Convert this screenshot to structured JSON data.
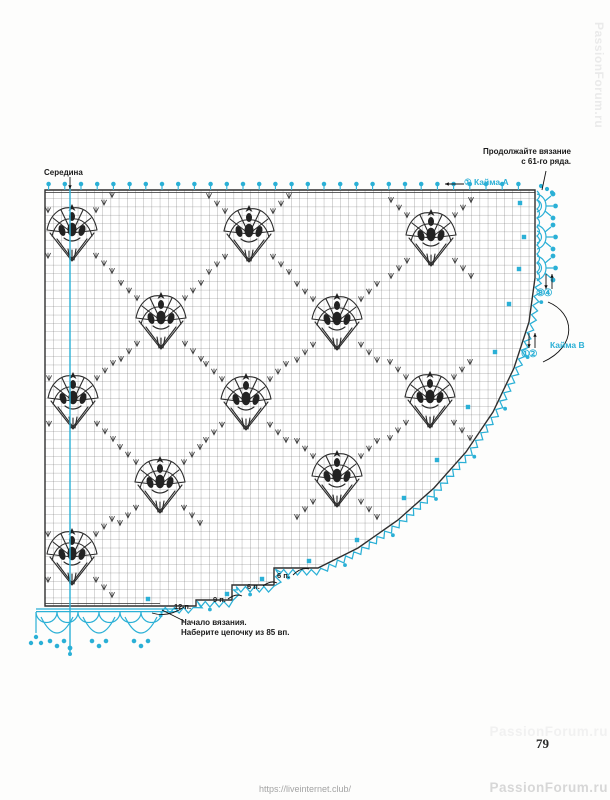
{
  "colors": {
    "accent": "#2bb0d6",
    "grid_line": "#6e6e6e",
    "outline": "#2f2f2f",
    "ink": "#111111",
    "watermark": "#d7d7d7",
    "url_text": "#a3a3a3"
  },
  "page": {
    "number": "79",
    "url": "https://liveinternet.club/",
    "watermark": "PassionForum.ru"
  },
  "labels": {
    "center": "Середина",
    "continue_line1": "Продолжайте вязание",
    "continue_line2": "с 61-го ряда.",
    "border_a": "① Кайма A",
    "border_b": "Кайма B",
    "border_b_rows_34": "③④",
    "border_b_rows_12": "①②",
    "start_line1": "Начало вязания.",
    "start_line2": "Наберите цепочку из 85 вп."
  },
  "chart": {
    "type": "crochet-filet-diagram",
    "description": "Filet crochet corner chart with tulip flower motifs, picot border A along top and right, shell border B along curved edge",
    "grid": {
      "left": 45,
      "top": 190,
      "cell": 8.2,
      "right": 535,
      "bottom": 606
    },
    "edge_points": [
      [
        535,
        278
      ],
      [
        529,
        322
      ],
      [
        514,
        368
      ],
      [
        493,
        412
      ],
      [
        466,
        452
      ],
      [
        434,
        488
      ],
      [
        398,
        520
      ],
      [
        358,
        548
      ],
      [
        318,
        568
      ],
      [
        274,
        568
      ],
      [
        274,
        585
      ],
      [
        232,
        585
      ],
      [
        232,
        600
      ],
      [
        196,
        600
      ],
      [
        196,
        606
      ],
      [
        160,
        606
      ]
    ],
    "center_line_x": 70,
    "flowers": [
      [
        72,
        233
      ],
      [
        249,
        234
      ],
      [
        431,
        238
      ],
      [
        161,
        321
      ],
      [
        337,
        322
      ],
      [
        73,
        401
      ],
      [
        246,
        402
      ],
      [
        430,
        400
      ],
      [
        160,
        485
      ],
      [
        337,
        479
      ],
      [
        72,
        557
      ]
    ],
    "cyan_markers": [
      [
        520,
        203
      ],
      [
        524,
        237
      ],
      [
        519,
        269
      ],
      [
        509,
        304
      ],
      [
        495,
        352
      ],
      [
        468,
        407
      ],
      [
        437,
        460
      ],
      [
        404,
        498
      ],
      [
        357,
        540
      ],
      [
        309,
        561
      ],
      [
        262,
        579
      ],
      [
        227,
        594
      ],
      [
        148,
        599
      ]
    ],
    "crown_centers_y": [
      206,
      237,
      268
    ],
    "steps": [
      {
        "label": "6 п.",
        "left": 277,
        "top": 571
      },
      {
        "label": "6 п.",
        "left": 247,
        "top": 582
      },
      {
        "label": "9 п.",
        "left": 213,
        "top": 595
      },
      {
        "label": "12 п.",
        "left": 174,
        "top": 602
      }
    ]
  }
}
